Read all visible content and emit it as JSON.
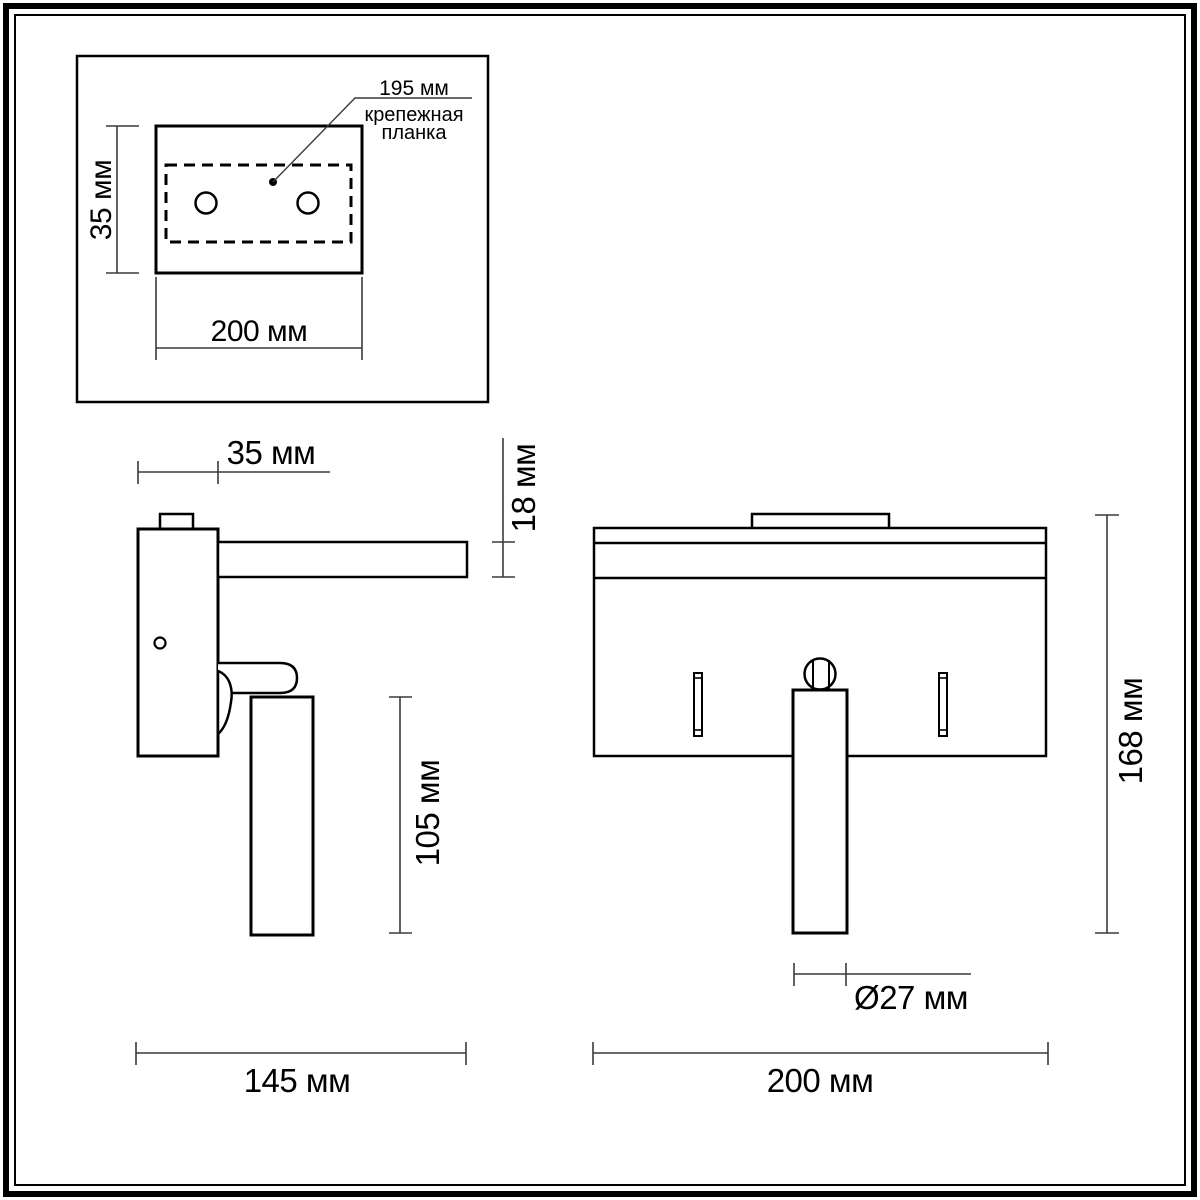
{
  "drawing": {
    "top_view": {
      "mount_spacing": "195 мм",
      "mount_plate_label_line1": "крепежная",
      "mount_plate_label_line2": "планка",
      "plate_height": "35 мм",
      "plate_width": "200 мм"
    },
    "side_view": {
      "body_depth": "35 мм",
      "shelf_thickness": "18 мм",
      "tube_length": "105 мм",
      "total_depth": "145 мм"
    },
    "front_view": {
      "total_height": "168 мм",
      "tube_diameter": "Ø27 мм",
      "total_width": "200 мм"
    },
    "colors": {
      "outline": "#000000",
      "dimension": "#3a3a3a",
      "background": "#ffffff"
    }
  }
}
